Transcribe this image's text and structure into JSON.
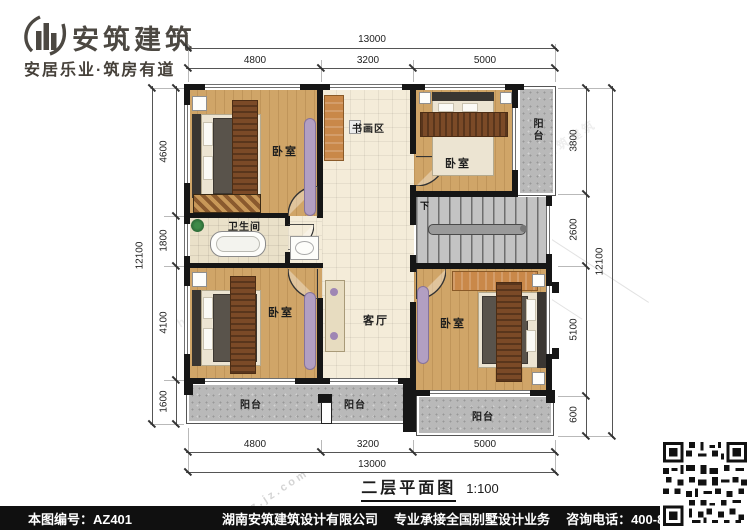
{
  "brand": {
    "logo_text": "安筑建筑",
    "tagline": "安居乐业·筑房有道"
  },
  "title": {
    "text": "二层平面图",
    "scale": "1:100"
  },
  "dimensions": {
    "top": {
      "total": "13000",
      "segments": [
        "4800",
        "3200",
        "5000"
      ]
    },
    "bottom": {
      "total": "13000",
      "segments": [
        "4800",
        "3200",
        "5000"
      ]
    },
    "left": {
      "total": "12100",
      "segments": [
        "4600",
        "1800",
        "4100",
        "1600"
      ]
    },
    "right": {
      "total": "12100",
      "segments": [
        "3800",
        "2600",
        "5100",
        "600"
      ]
    }
  },
  "rooms": {
    "bedroom": "卧室",
    "living": "客厅",
    "bathroom": "卫生间",
    "art_area": "书画区",
    "balcony": "阳台",
    "stairs_down": "下"
  },
  "footer": {
    "drawing_no": "本图编号：AZ401",
    "company": "湖南安筑建筑设计有限公司",
    "service": "专业承接全国别墅设计业务",
    "phone": "咨询电话：400-8070-511",
    "web": "网"
  },
  "watermarks": [
    "安筑建筑",
    "hnaz.jz.com"
  ],
  "colors": {
    "wall": "#161616",
    "wood": "#d0a568",
    "tile": "#f4ecd9",
    "granite": "#b9b9b9",
    "purple": "#b29fc2",
    "desk": "#c98849",
    "runner": "#7b4a27",
    "footer_bg": "#101010"
  }
}
